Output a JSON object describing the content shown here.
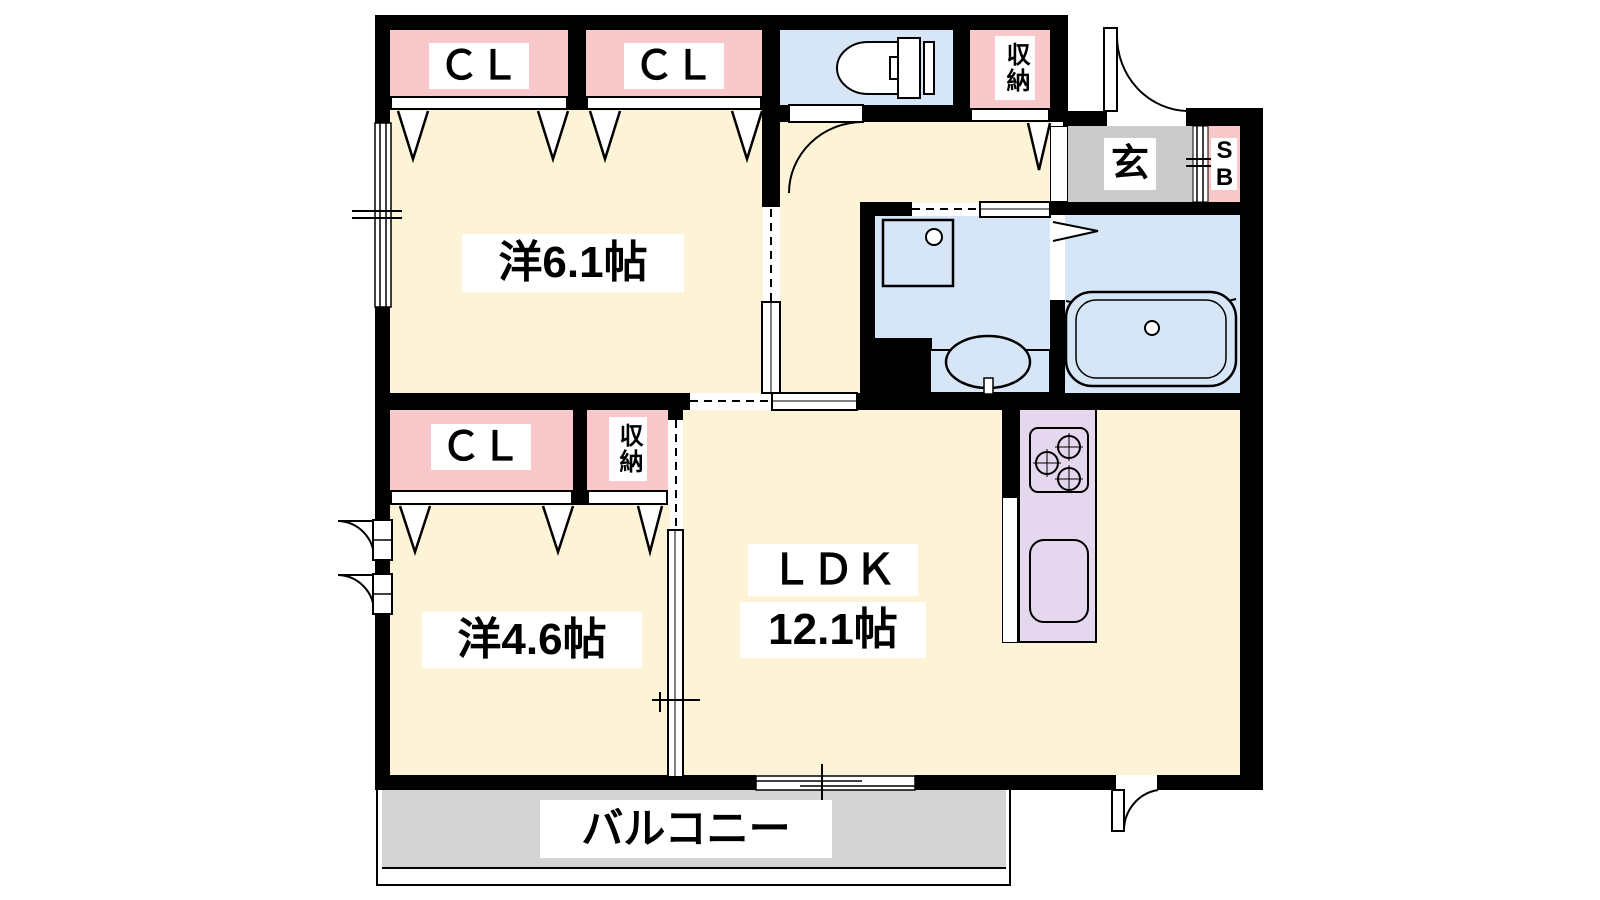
{
  "floorplan": {
    "type": "apartment-floor-plan",
    "rooms": {
      "bedroom1": {
        "label": "洋6.1帖"
      },
      "bedroom2": {
        "label": "洋4.6帖"
      },
      "ldk": {
        "label": "ＬＤＫ",
        "size": "12.1帖"
      },
      "balcony": {
        "label": "バルコニー"
      },
      "entrance": {
        "label": "玄"
      },
      "shoe_box": {
        "label": "SB"
      },
      "closet_top_left": {
        "label": "ＣＬ"
      },
      "closet_top_mid": {
        "label": "ＣＬ"
      },
      "closet_bottom": {
        "label": "ＣＬ"
      },
      "storage_top": {
        "label": "収納"
      },
      "storage_bottom": {
        "label": "収納"
      }
    },
    "colors": {
      "wall": "#000000",
      "floor_cream": "#fdf3d6",
      "closet_pink": "#f9c8cb",
      "water_blue": "#d6e6f7",
      "entrance_gray": "#cbcbcb",
      "balcony_gray": "#d4d4d4",
      "kitchen_purple": "#e4d7ee"
    }
  }
}
